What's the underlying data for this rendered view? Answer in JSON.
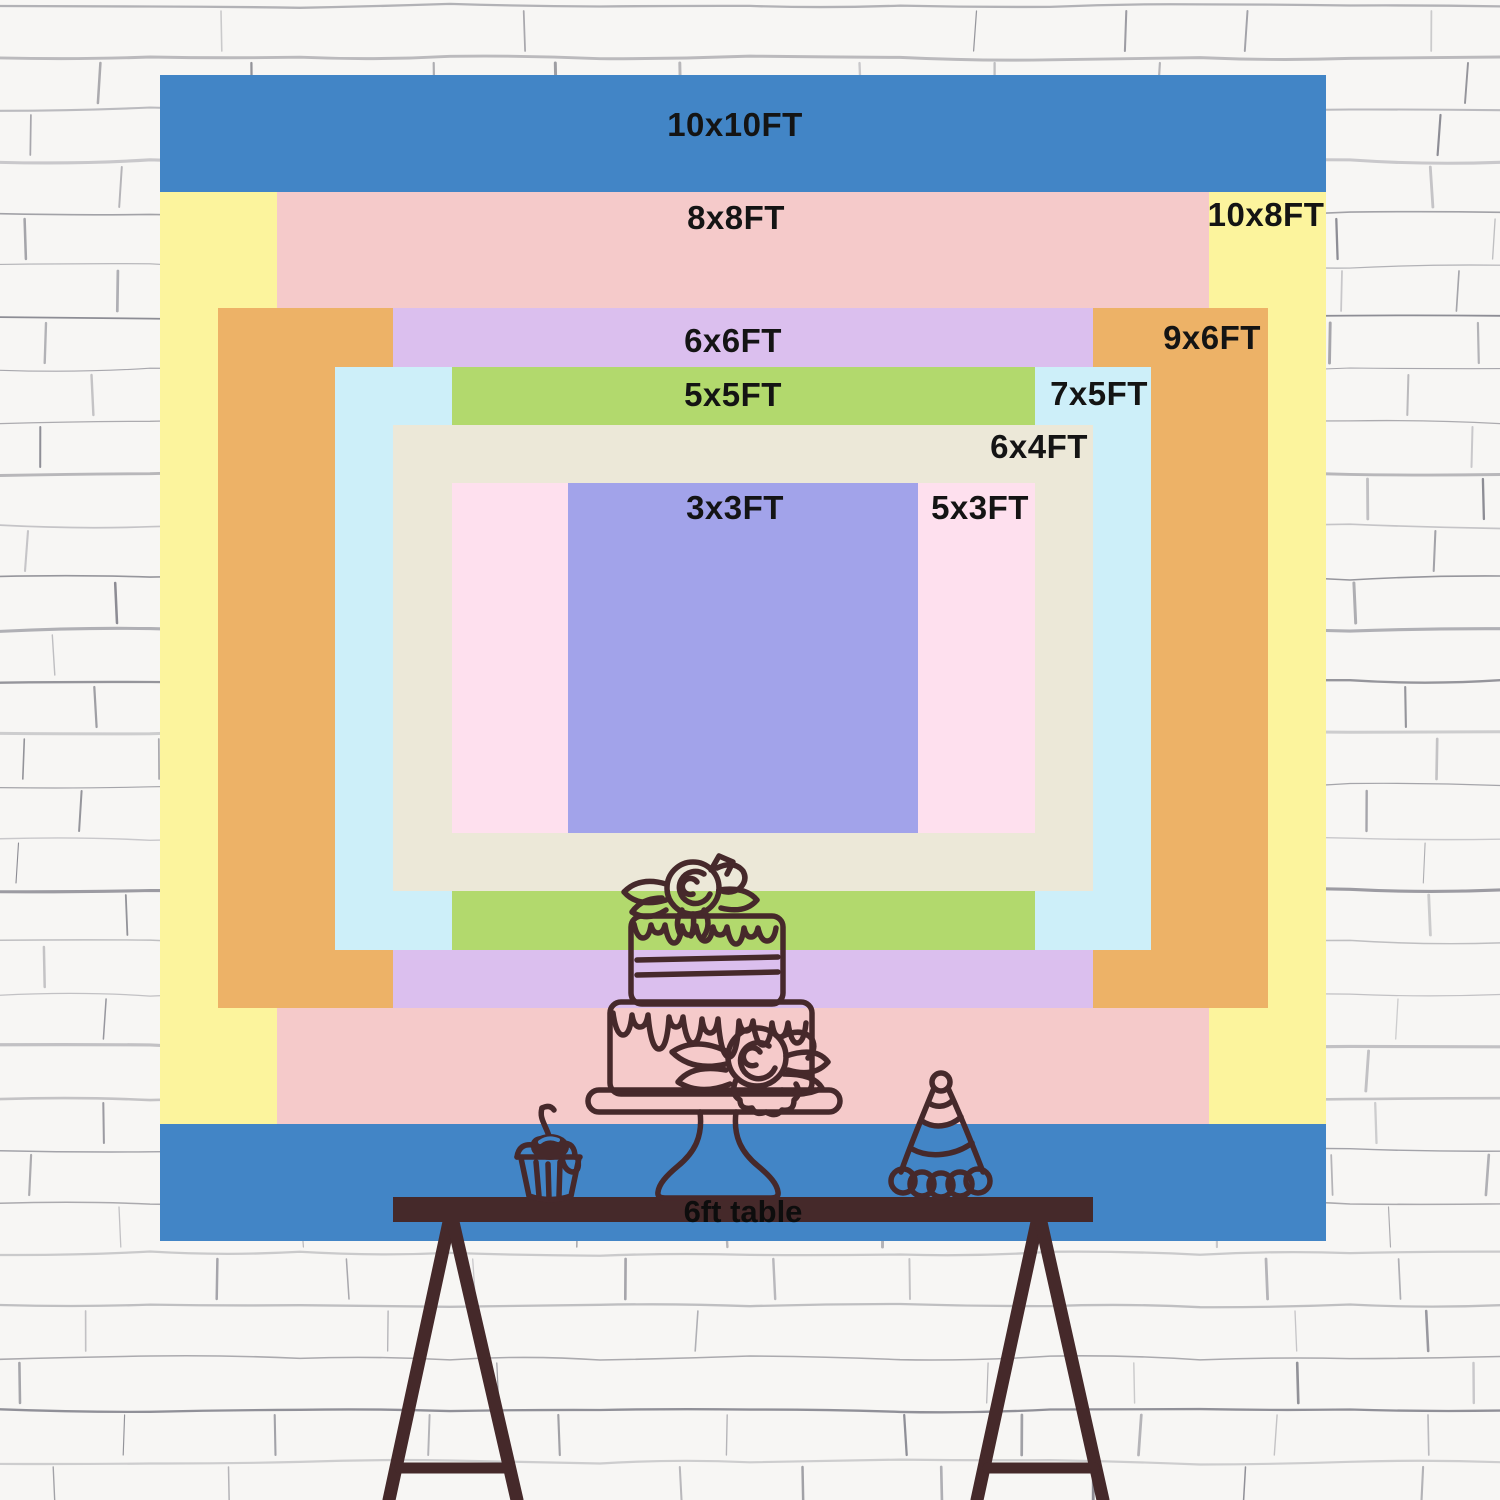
{
  "backdrop_chart": {
    "title_unit": "FT",
    "center_x": 743,
    "center_y": 658,
    "px_per_ft": 116.6,
    "label_color": "#141414",
    "sizes": [
      {
        "label": "10x10FT",
        "width_ft": 10,
        "height_ft": 10,
        "color": "#4285c6",
        "label_x": 735,
        "label_y": 125
      },
      {
        "label": "10x8FT",
        "width_ft": 10,
        "height_ft": 8,
        "color": "#fcf49d",
        "label_x": 1266,
        "label_y": 215
      },
      {
        "label": "8x8FT",
        "width_ft": 8,
        "height_ft": 8,
        "color": "#f5caca",
        "label_x": 736,
        "label_y": 218
      },
      {
        "label": "9x6FT",
        "width_ft": 9,
        "height_ft": 6,
        "color": "#edb267",
        "label_x": 1212,
        "label_y": 338
      },
      {
        "label": "6x6FT",
        "width_ft": 6,
        "height_ft": 6,
        "color": "#dbbfee",
        "label_x": 733,
        "label_y": 341
      },
      {
        "label": "7x5FT",
        "width_ft": 7,
        "height_ft": 5,
        "color": "#cdeff9",
        "label_x": 1099,
        "label_y": 394
      },
      {
        "label": "5x5FT",
        "width_ft": 5,
        "height_ft": 5,
        "color": "#b2d96d",
        "label_x": 733,
        "label_y": 395
      },
      {
        "label": "6x4FT",
        "width_ft": 6,
        "height_ft": 4,
        "color": "#ece8d8",
        "label_x": 1039,
        "label_y": 447
      },
      {
        "label": "5x3FT",
        "width_ft": 5,
        "height_ft": 3,
        "color": "#fee0ee",
        "label_x": 980,
        "label_y": 508
      },
      {
        "label": "3x3FT",
        "width_ft": 3,
        "height_ft": 3,
        "color": "#a2a3ea",
        "label_x": 735,
        "label_y": 508
      }
    ]
  },
  "table": {
    "label": "6ft table",
    "color": "#45292a",
    "text_color": "#0d0d0d"
  },
  "illustration": {
    "stroke_color": "#46292b",
    "items": [
      "two-tier-cake",
      "cupcake",
      "party-hat",
      "trestle-table"
    ]
  },
  "wall": {
    "background": "#f7f6f4",
    "line_color": "#70707a"
  }
}
